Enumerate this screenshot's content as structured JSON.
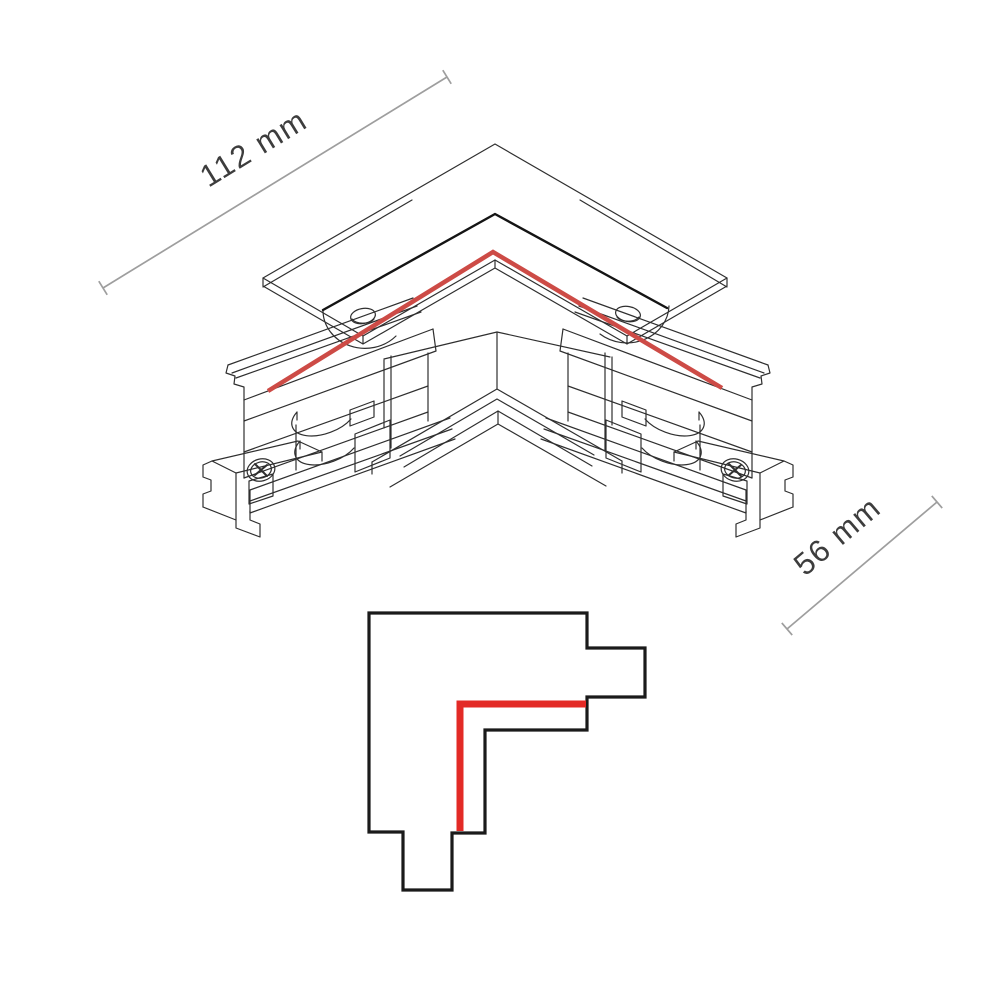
{
  "figure": {
    "type": "technical-drawing",
    "subject": "L-shaped track lighting corner connector",
    "views": [
      "isometric-view",
      "top-view-schematic"
    ]
  },
  "dimensions": {
    "width_label": "112 mm",
    "depth_label": "56 mm"
  },
  "colors": {
    "line": "#2f2f2f",
    "dark_edge": "#141414",
    "red_iso": "#cd4b46",
    "red_schematic": "#e32a26",
    "schematic_outline": "#1a1a1a",
    "dimension_line": "#9e9e9e",
    "dimension_text": "#3d3d3d",
    "background": "#ffffff"
  }
}
